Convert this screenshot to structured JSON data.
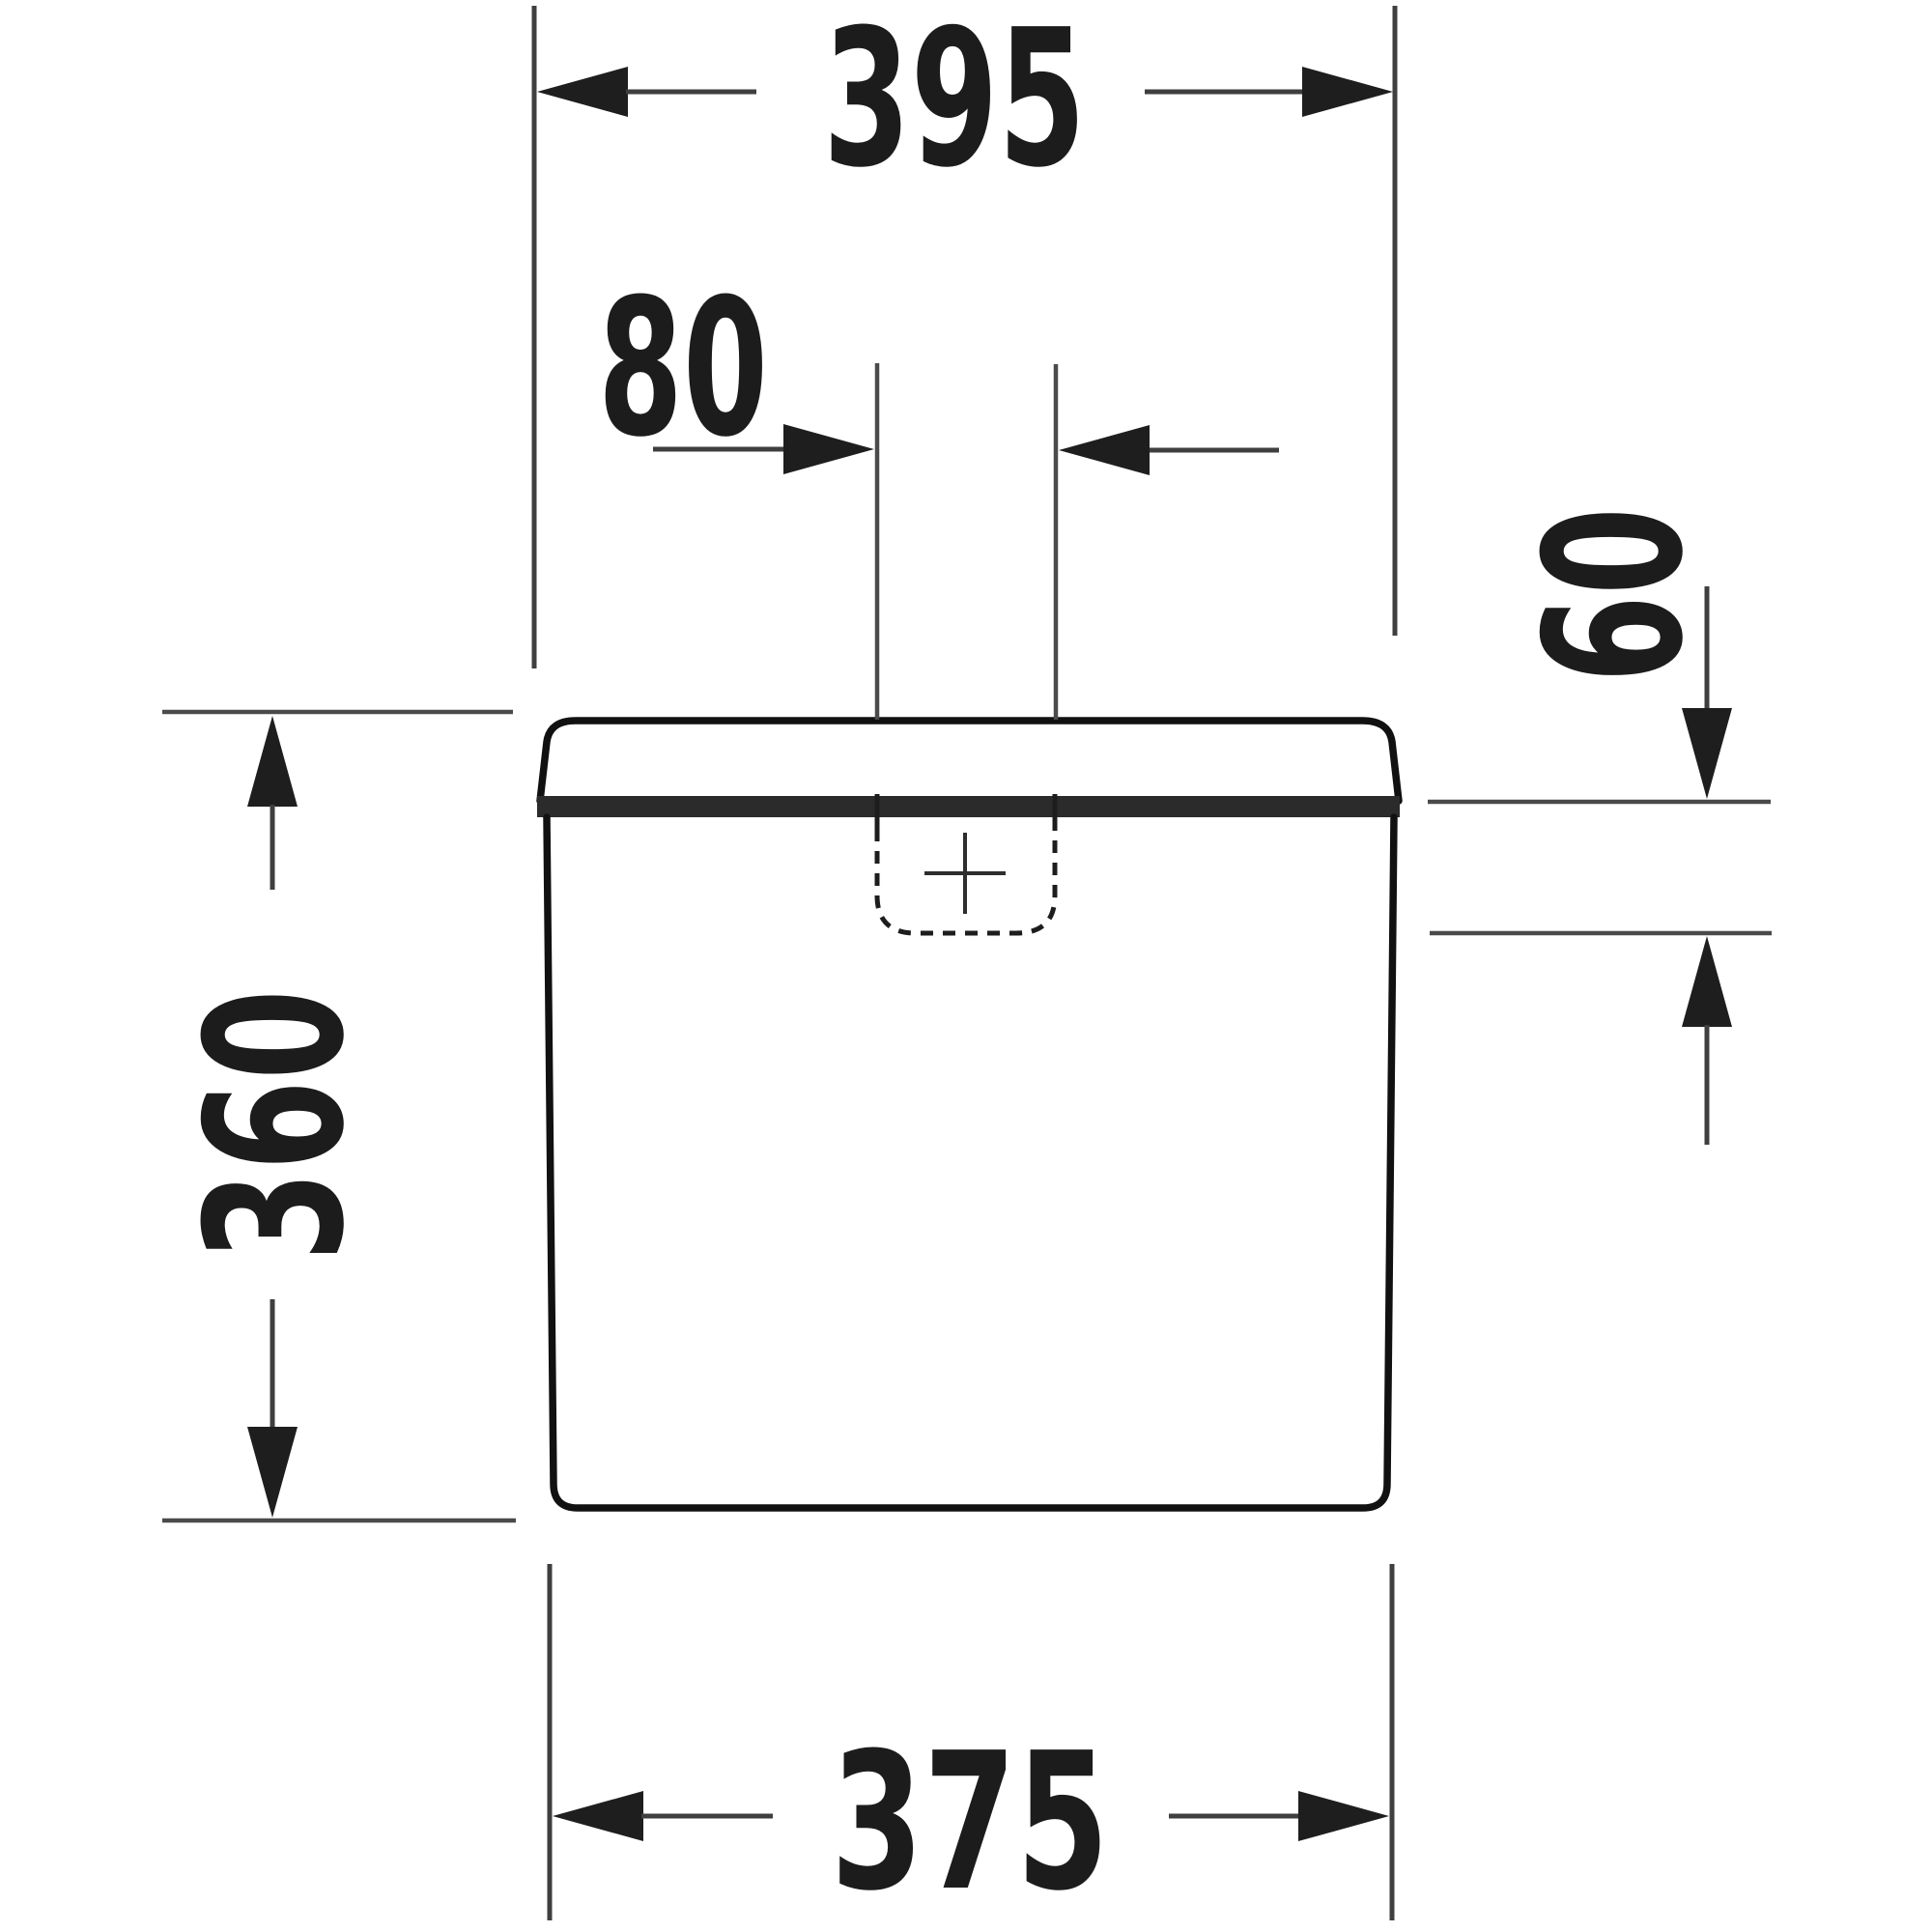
{
  "diagram": {
    "dimension_labels": {
      "top_width": "395",
      "cutout_width": "80",
      "lid_height": "60",
      "tank_height": "360",
      "bottom_width": "375"
    },
    "colors": {
      "outline": "#111111",
      "seam_band": "#2b2b2b",
      "dimension_line": "#3f3f3f",
      "reference_line": "#4a4a4a",
      "label_text": "#1c1c1c",
      "background": "#ffffff"
    }
  }
}
